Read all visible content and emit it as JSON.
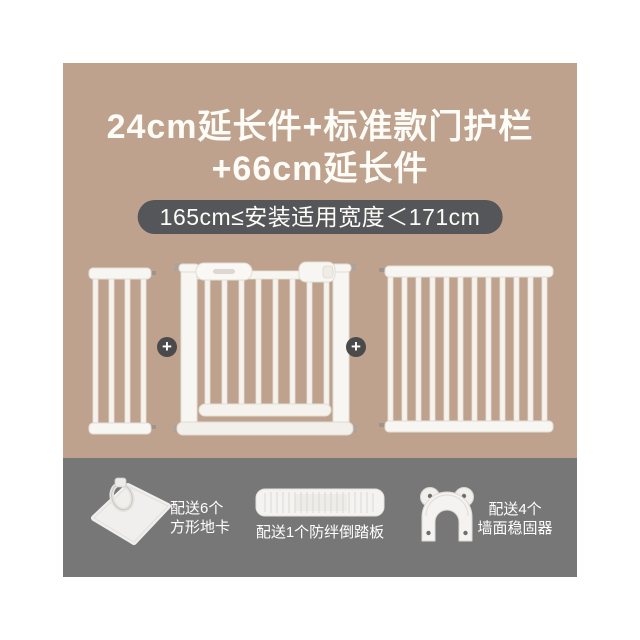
{
  "colors": {
    "background": "#ffffff",
    "panel_top_bg": "#bfa28e",
    "panel_bottom_bg": "#777777",
    "badge_bg": "#55565a",
    "text_light": "#fdfcf7",
    "plus_circle_bg": "#4a4a4b",
    "product_white": "#f8f6f2"
  },
  "header": {
    "title_line1": "24cm延长件+标准款门护栏",
    "title_line2": "+66cm延长件",
    "badge_text": "165cm≤安装适用宽度＜171cm"
  },
  "bundle": {
    "plus_symbol": "+",
    "items": [
      {
        "icon": "extension-panel-24cm-icon"
      },
      {
        "icon": "standard-door-gate-icon"
      },
      {
        "icon": "extension-panel-66cm-icon"
      }
    ]
  },
  "accessories": [
    {
      "icon": "floor-card-icon",
      "line1": "配送6个",
      "line2": "方形地卡"
    },
    {
      "icon": "pedal-icon",
      "line1": "配送1个防绊倒踏板"
    },
    {
      "icon": "wall-stabilizer-icon",
      "line1": "配送4个",
      "line2": "墙面稳固器"
    }
  ]
}
